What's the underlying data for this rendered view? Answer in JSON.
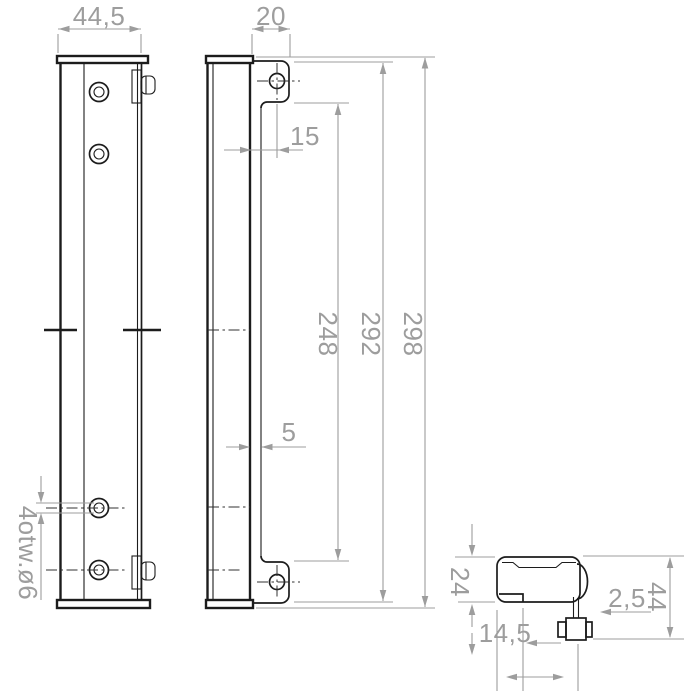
{
  "drawing": {
    "kind": "technical-drawing",
    "subject": "mounting bracket rails with hook-bolt, three views"
  },
  "dims": {
    "left_width": "44,5",
    "holes_note": "4otw.ø6",
    "ear_width": "20",
    "hole_inset": "15",
    "inner_span": "248",
    "ear_span": "292",
    "overall_height": "298",
    "plate_gap": "5",
    "section_height": "24",
    "lip_width": "14,5",
    "bolt_offset": "2,5",
    "section_depth": "44"
  },
  "colors": {
    "outline": "#1c1c1c",
    "dimension": "#9d9d9d",
    "centerline": "#303030",
    "background": "#ffffff"
  }
}
